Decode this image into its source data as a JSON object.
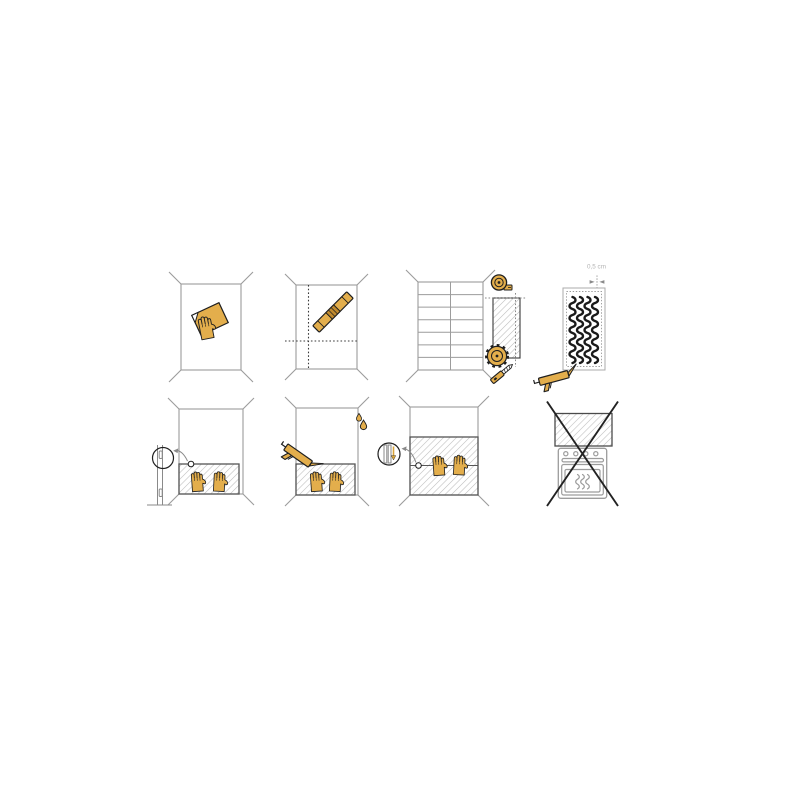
{
  "colors": {
    "background": "#ffffff",
    "accent_yellow": "#e3ae4c",
    "accent_yellow_dark": "#c08a2e",
    "outline_black": "#1f1f1f",
    "wall_gray": "#9c9c9c",
    "panel_edge_gray": "#555555",
    "hatch_gray": "#bcbcbc",
    "detail_gray": "#8a8a8a",
    "label_gray": "#b3b3b3",
    "cross_black": "#222222"
  },
  "steps": [
    {
      "id": 1,
      "name": "clean-wall",
      "icons": [
        "wall-frame",
        "hand-with-cloth-icon"
      ]
    },
    {
      "id": 2,
      "name": "mark-guide-lines",
      "icons": [
        "wall-frame",
        "plumb-line-dotted",
        "level-line-dotted",
        "spirit-level-icon"
      ]
    },
    {
      "id": 3,
      "name": "measure-and-cut-panel",
      "icons": [
        "tiled-wall",
        "measuring-tape-icon",
        "cut-panel",
        "cut-lines-dotted",
        "circular-saw-icon",
        "utility-knife-icon"
      ]
    },
    {
      "id": 4,
      "name": "apply-adhesive-to-back",
      "label": "0,5 cm",
      "icons": [
        "panel-back",
        "adhesive-dotted-border",
        "glue-beads",
        "caulk-gun-icon",
        "measurement-arrows"
      ]
    },
    {
      "id": 5,
      "name": "set-panel-on-spacers-and-press",
      "icons": [
        "wall-frame",
        "mounted-panel",
        "pressing-hand-icon",
        "spacer-strip",
        "spacer-detail-circle",
        "detail-arrow"
      ]
    },
    {
      "id": 6,
      "name": "press-and-seal-top-edge",
      "icons": [
        "wall-frame",
        "mounted-panel",
        "pressing-hand-icon",
        "caulk-gun-icon",
        "water-drop-icon"
      ]
    },
    {
      "id": 7,
      "name": "join-upper-panel-and-press",
      "icons": [
        "wall-frame",
        "mounted-panels",
        "seam-line",
        "pressing-hand-icon",
        "joint-detail-circle",
        "joint-arrow-icon",
        "detail-arrow"
      ]
    },
    {
      "id": 8,
      "name": "do-not-install-above-stove",
      "icons": [
        "hatched-panel",
        "oven-icon",
        "oven-knobs",
        "heat-waves-icon",
        "prohibition-cross-icon"
      ]
    }
  ]
}
